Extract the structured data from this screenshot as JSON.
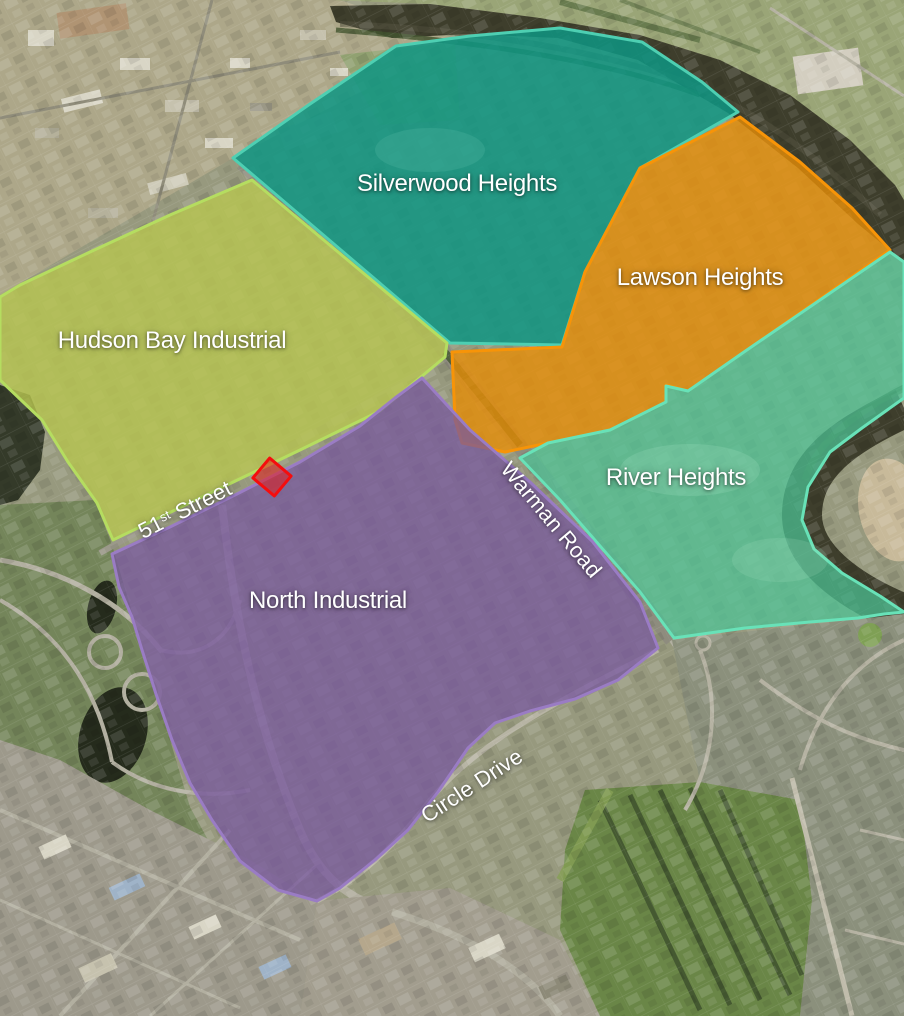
{
  "map": {
    "description": "Aerial neighbourhood overlay map",
    "label_color": "#ffffff",
    "regions": [
      {
        "name": "Silverwood Heights",
        "fill": "#0e9582",
        "border": "#4ecfb2"
      },
      {
        "name": "Lawson Heights",
        "fill": "#e68d07",
        "border": "#f79408"
      },
      {
        "name": "Hudson Bay Industrial",
        "fill": "#b8c550",
        "border": "#b5dd60"
      },
      {
        "name": "River Heights",
        "fill": "#4cc496",
        "border": "#68e2b8"
      },
      {
        "name": "North Industrial",
        "fill": "#77569e",
        "border": "#9a7cc4"
      }
    ],
    "road_labels": [
      {
        "name": "51st Street",
        "number": "51",
        "ordinal": "st",
        "suffix": " Street"
      },
      {
        "name": "Warman Road"
      },
      {
        "name": "Circle Drive"
      }
    ],
    "marker": {
      "name": "highlighted-parcel",
      "fill": "#e51a1a",
      "border": "#f50d0d"
    }
  }
}
